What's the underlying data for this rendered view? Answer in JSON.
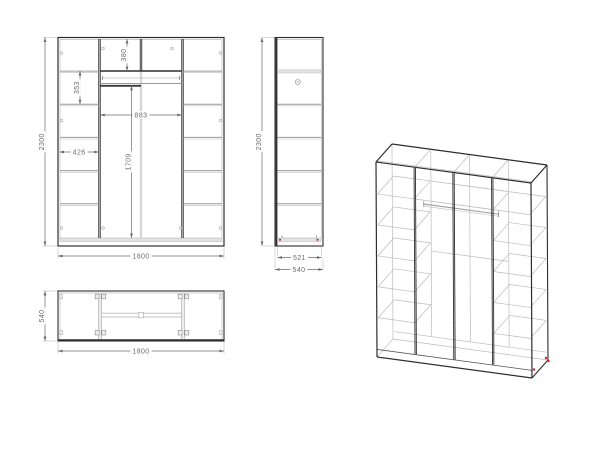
{
  "drawing": {
    "subject": "wardrobe technical drawing with front, side, plan and isometric views",
    "background": "#ffffff",
    "colors": {
      "line_dark": "#2e2e2e",
      "line_mid": "#9c9c9c",
      "line_light": "#bcbcbc",
      "panel_fill": "#e2e2e2",
      "dim_color": "#6b6b6b",
      "accent_red": "#e02020"
    },
    "views": {
      "front": {
        "name": "front-elevation",
        "dims": {
          "overall_height": "2300",
          "overall_width": "1800",
          "top_compartment_height": "380",
          "left_shelf_gap": "353",
          "middle_width": "883",
          "left_width": "426",
          "middle_height": "1709"
        }
      },
      "side": {
        "name": "side-elevation",
        "dims": {
          "overall_height": "2300",
          "inner_depth": "521",
          "overall_depth": "540"
        }
      },
      "top": {
        "name": "plan-view",
        "dims": {
          "overall_depth": "540",
          "overall_width": "1800"
        }
      },
      "iso": {
        "name": "isometric-projection"
      }
    },
    "model_mm": {
      "width": 1800,
      "height": 2300,
      "depth": 540,
      "panel": 16,
      "plinth": 90,
      "partitions": [
        450,
        900,
        1350
      ],
      "shelf_heights": [
        465,
        830,
        1195,
        1560,
        1925
      ],
      "rail_height": 1770
    }
  }
}
